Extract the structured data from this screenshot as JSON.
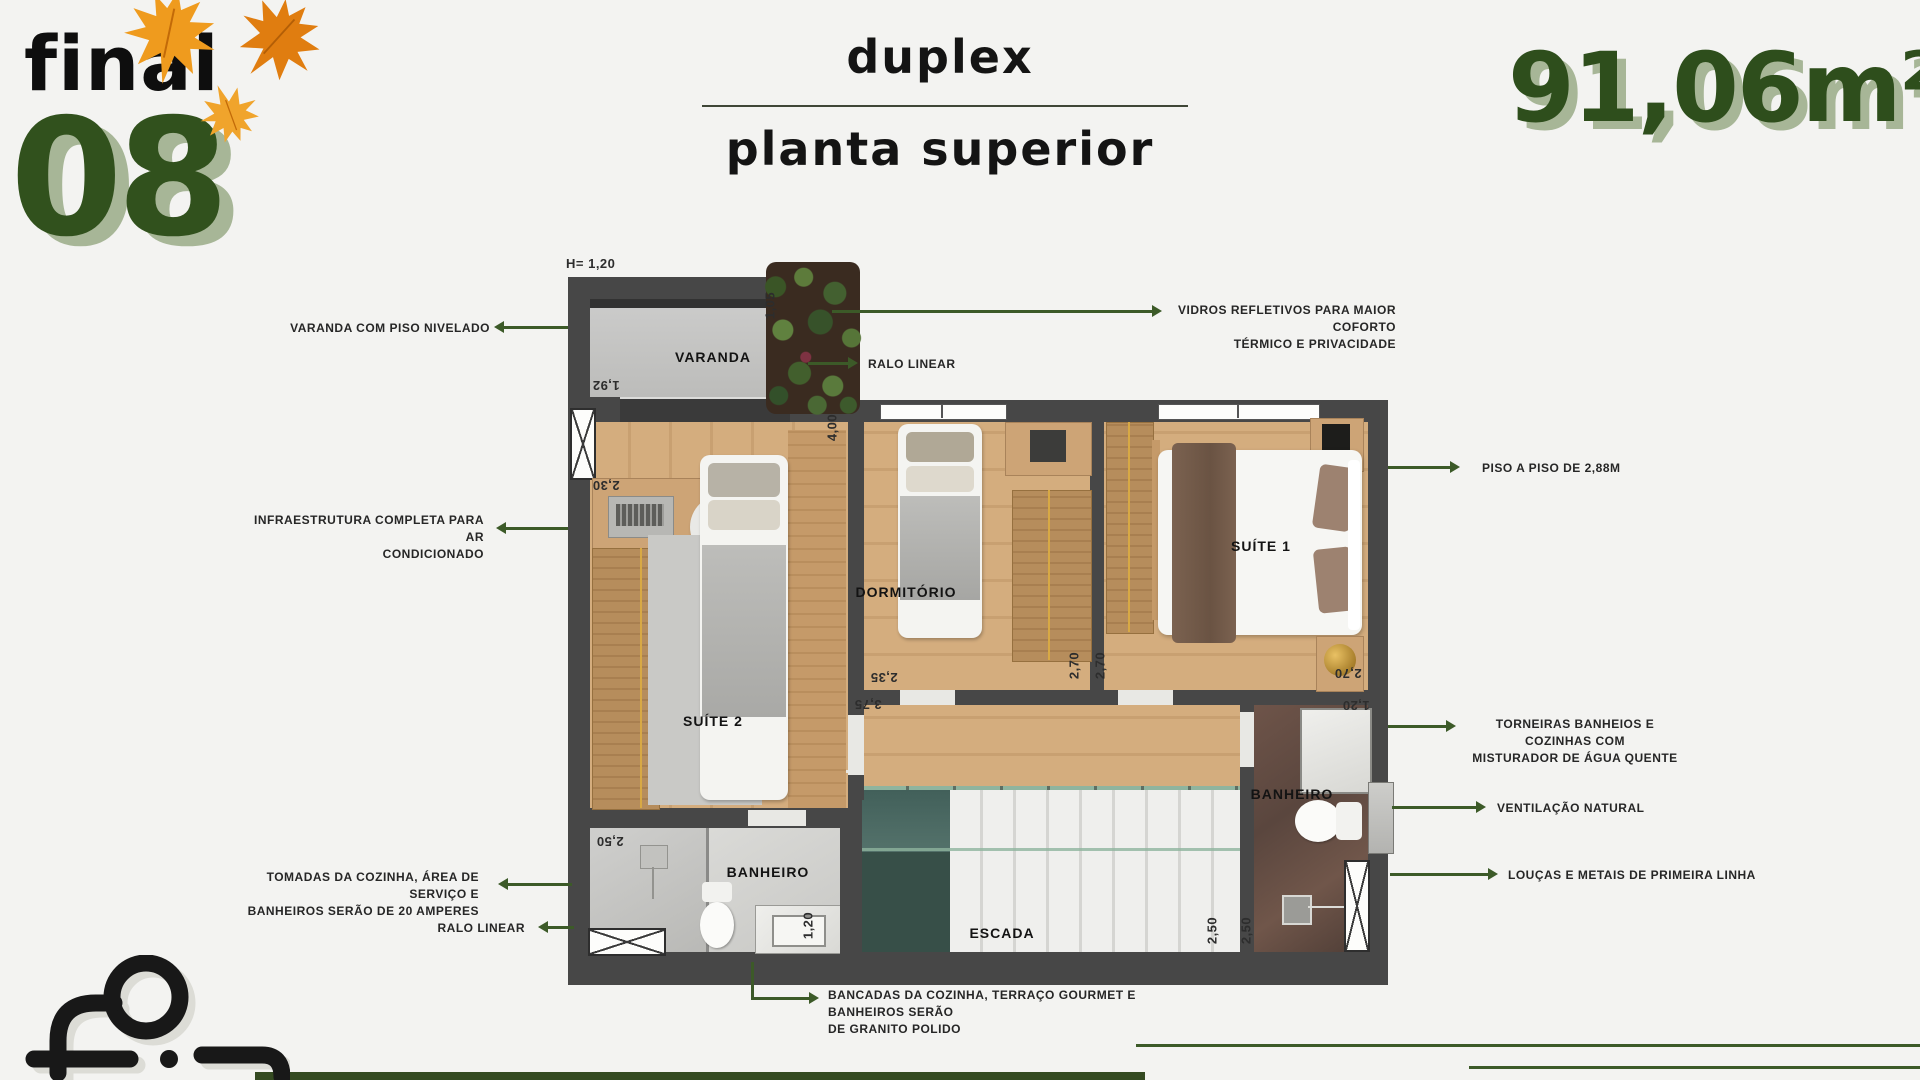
{
  "header": {
    "unit_label": "final",
    "unit_number": "08",
    "title": "duplex",
    "subtitle": "planta superior",
    "area": "91,06m²"
  },
  "plan": {
    "height_note": "H= 1,20",
    "rooms": {
      "varanda": "VARANDA",
      "suite2": "SUÍTE 2",
      "dormitorio": "DORMITÓRIO",
      "suite1": "SUÍTE 1",
      "banheiro1": "BANHEIRO",
      "banheiro2": "BANHEIRO",
      "escada": "ESCADA"
    },
    "dims": {
      "varanda_depth": "1,05",
      "varanda_width": "1,92",
      "suite2_width": "2,30",
      "suite2_length": "4,00",
      "dormitorio_width": "2,35",
      "hall_width": "3,75",
      "dorm_depth": "2,70",
      "suite1_depth": "2,70",
      "suite1_width": "2,70",
      "shower_width": "1,20",
      "stairs_width": "2,50",
      "banheiro2_width": "2,50",
      "banheiro1_width": "2,50",
      "banheiro1_depth": "1,20"
    }
  },
  "callouts": {
    "varanda_piso": "VARANDA COM PISO NIVELADO",
    "vidros_l1": "VIDROS REFLETIVOS PARA MAIOR COFORTO",
    "vidros_l2": "TÉRMICO E PRIVACIDADE",
    "ralo_top": "RALO LINEAR",
    "infra_l1": "INFRAESTRUTURA COMPLETA PARA AR",
    "infra_l2": "CONDICIONADO",
    "piso_a_piso": "PISO A  PISO DE 2,88M",
    "torneiras_l1": "TORNEIRAS BANHEIOS E COZINHAS COM",
    "torneiras_l2": "MISTURADOR DE ÁGUA QUENTE",
    "ventilacao": "VENTILAÇÃO NATURAL",
    "loucas": "LOUÇAS E METAIS DE PRIMEIRA LINHA",
    "tomadas_l1": "TOMADAS DA COZINHA, ÁREA DE SERVIÇO E",
    "tomadas_l2": "BANHEIROS SERÃO DE 20 AMPERES",
    "ralo_bottom": "RALO LINEAR",
    "bancadas_l1": "BANCADAS DA COZINHA, TERRAÇO GOURMET E BANHEIROS SERÃO",
    "bancadas_l2": "DE GRANITO POLIDO"
  },
  "colors": {
    "background": "#f3f3f1",
    "accent_green": "#3c5a28",
    "number_green": "#2e4e1c",
    "number_shadow": "#a7b697",
    "leaf_orange": "#ea8c15",
    "wall_gray": "#474747",
    "wood_floor": "#d0a978",
    "stair_glass_teal": "#42605a",
    "footer_bar_green": "#344a21"
  }
}
